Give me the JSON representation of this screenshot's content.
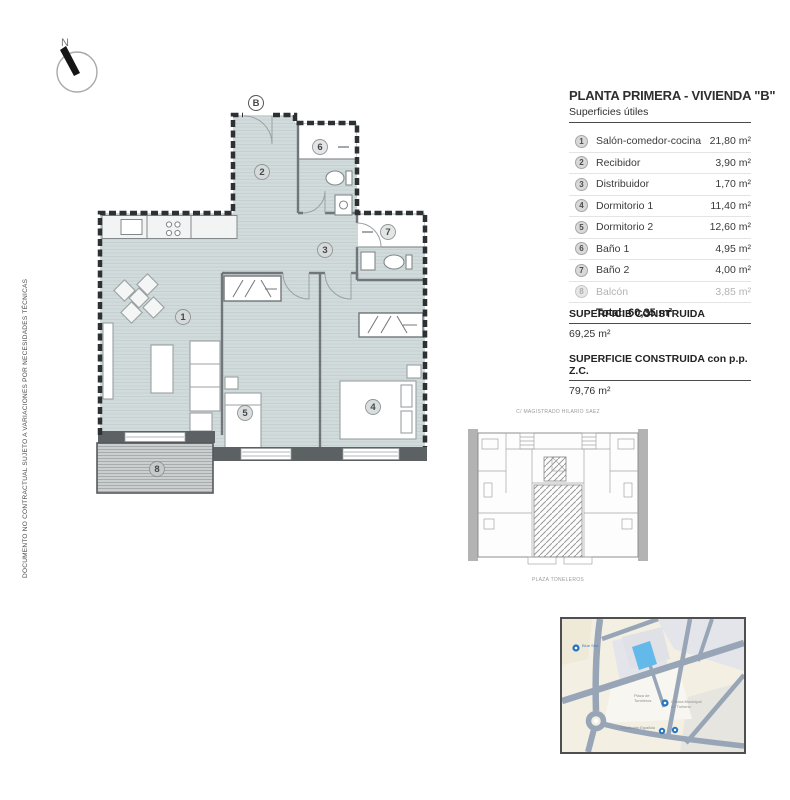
{
  "disclaimer": "DOCUMENTO NO CONTRACTUAL SUJETO A VARIACIONES POR NECESIDADES TÉCNICAS",
  "compass": {
    "north_label": "N"
  },
  "title_block": {
    "title": "PLANTA PRIMERA - VIVIENDA \"B\"",
    "subtitle": "Superficies útiles",
    "rooms": [
      {
        "num": "1",
        "label": "Salón-comedor-cocina",
        "area": "21,80 m²"
      },
      {
        "num": "2",
        "label": "Recibidor",
        "area": "3,90 m²"
      },
      {
        "num": "3",
        "label": "Distribuidor",
        "area": "1,70 m²"
      },
      {
        "num": "4",
        "label": "Dormitorio 1",
        "area": "11,40 m²"
      },
      {
        "num": "5",
        "label": "Dormitorio 2",
        "area": "12,60 m²"
      },
      {
        "num": "6",
        "label": "Baño 1",
        "area": "4,95 m²"
      },
      {
        "num": "7",
        "label": "Baño 2",
        "area": "4,00 m²"
      },
      {
        "num": "8",
        "label": "Balcón",
        "area": "3,85 m²"
      }
    ],
    "total": "Total: 60,35 m²"
  },
  "built_area": {
    "label1": "SUPERFICIE CONSTRUIDA",
    "value1": "69,25 m²",
    "label2": "SUPERFICIE CONSTRUIDA con p.p. Z.C.",
    "value2": "79,76 m²"
  },
  "floor_plan": {
    "entrance_label": "B",
    "rooms": {
      "r1": "1",
      "r2": "2",
      "r3": "3",
      "r4": "4",
      "r5": "5",
      "r6": "6",
      "r7": "7",
      "r8": "8"
    }
  },
  "key_plan": {
    "street_top": "C/ MAGISTRADO HILARIO SAEZ",
    "street_bottom": "PLAZA TONELEROS"
  },
  "map": {
    "labels": {
      "poi1": "Blue Sea",
      "plaza_line1": "Plaza de",
      "plaza_line2": "Toneleros",
      "office_line1": "Oficina Municipal",
      "office_line2": "de Turismo",
      "street": "Constitución Española"
    }
  },
  "colors": {
    "floor": "#d2dbdc",
    "wall_dark": "#5c6164",
    "map_building_blue": "#63b9e9",
    "map_poi_blue": "#2776c0"
  }
}
